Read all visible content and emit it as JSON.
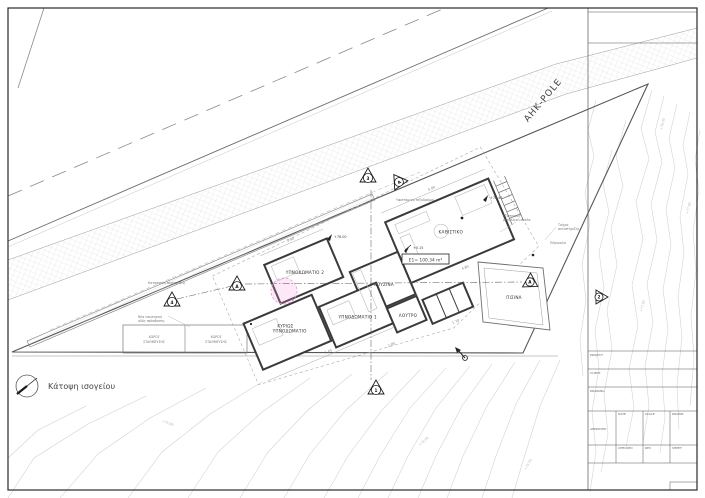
{
  "drawing": {
    "caption": "Κάτοψη ισογείου",
    "road_label": "ΑΗΚ-POLE",
    "area_label": "Ε1= 100.34 m²"
  },
  "rooms": {
    "living": "ΚΑΘΙΣΤΙΚΟ",
    "kitchen": "ΚΟΥΖΙΝΑ",
    "bedroom2": "ΥΠΝΟΔΩΜΑΤΙΟ 2",
    "master1": "ΚΥΡΙΩΣ",
    "master2": "ΥΠΝΟΔΩΜΑΤΙΟ",
    "bedroom1": "ΥΠΝΟΔΩΜΑΤΙΟ 1",
    "bath": "ΛΟΥΤΡΟ",
    "pool": "ΠΙΣΙΝΑ"
  },
  "parking": {
    "line1": "ΧΩΡΟΣ",
    "line2": "ΣΤΑΘΜΕΥΣΗΣ"
  },
  "annotations": {
    "fence": "Κατασκευή περίφραξης",
    "access1": "Νέα εσωτερική",
    "access2": "οδός πρόσβασης",
    "sidewalk": "Υφιστάμενο πεζοδρόμιο",
    "stair1": "Εξωτερική",
    "stair2": "μεταλλική σκάλα",
    "pergola": "Πέργκολα",
    "retaining1": "Τοίχος",
    "retaining2": "αντιστήριξης"
  },
  "levels": {
    "l1": "+78.00",
    "l2": "+78.45",
    "l3": "+0.15"
  },
  "contour_labels": [
    "+76.50",
    "+77.00",
    "+77.50",
    "+75.80",
    "+76.00",
    "+75.50"
  ],
  "markers": {
    "m3": "3",
    "mA1": "A",
    "m4": "4",
    "mA2": "A",
    "m1": "1",
    "mA3": "A",
    "m2": "2"
  },
  "dims": {
    "d1": "7.49",
    "d2": "3.90",
    "d3": "2.00",
    "d4": "4.85",
    "d5": "1.70",
    "d6": "5.06"
  },
  "titleblock": {
    "project": "PROJECT",
    "client": "CLIENT",
    "drawing": "DRAWING",
    "date": "DATE",
    "scale": "SCALE",
    "drawn": "DRAWN",
    "checked": "CHECKED",
    "approved": "APPROVED",
    "rev": "REV",
    "sheet": "SHEET"
  },
  "colors": {
    "line": "#444444",
    "light": "#bbbbbb",
    "contour": "#d0d0d0",
    "highlight": "#e88fd8"
  }
}
